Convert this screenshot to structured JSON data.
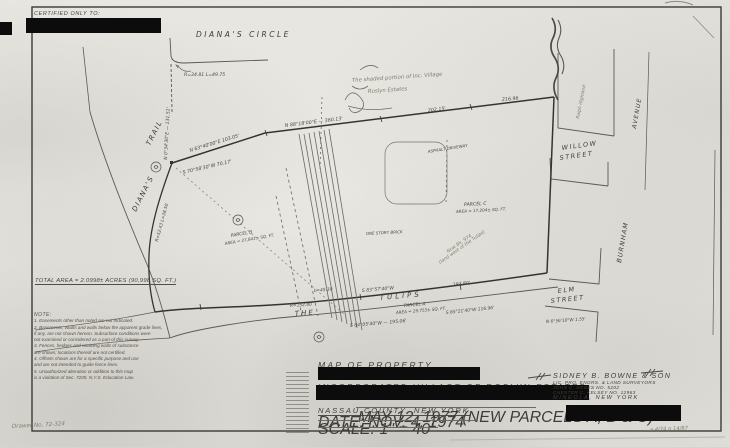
{
  "certified": {
    "label": "CERTIFIED ONLY TO:"
  },
  "streets": {
    "dianas_circle": "DIANA'S   CIRCLE",
    "dianas": "DIANA'S",
    "trail": "TRAIL",
    "the": "THE",
    "tulips": "TULIPS",
    "willow_1": "WILLOW",
    "willow_2": "STREET",
    "elm_1": "ELM",
    "elm_2": "STREET",
    "burnham": "BURNHAM",
    "avenue": "AVENUE"
  },
  "bearings": {
    "circle_curve": "R=34.81  L=49.75",
    "trail_vertical": "N 0°34'30\"E — 131.51'",
    "trail_curve": "R=52.43  L=38.50",
    "north_1": "N 63°40'00\"E  103.05'",
    "junction": "S 70°58'30\"W  70.17'",
    "north_2": "N 88°18'00\"E — 360.13'",
    "north_2b": "202.15'",
    "north_2c": "216.96",
    "tulips_arc": "L=45.30",
    "tulips_1": "S 83°57'40\"W",
    "tulips_1b": "193.80'",
    "tulips_radius": "R=152.80",
    "tulips_2": "S 84°05'40\"W — 195.06'",
    "tulips_3": "S 85°21'40\"W   116.96'",
    "elm_offset": "N 6°56'10\"W  1.55'"
  },
  "parcels": {
    "a_name": "PARCEL A",
    "a_area": "AREA = 29,753± SQ. FT.",
    "b_name": "PARCEL B",
    "b_area": "AREA = 27,841± SQ. FT.",
    "c_name": "PARCEL C",
    "c_area": "AREA = 17,204± SQ. FT.",
    "total": "TOTAL AREA = 2.0998± ACRES  (90,998 SQ. FT.)"
  },
  "building": {
    "label": "ONE STORY BRICK",
    "driveway": "ASPHALT DRIVEWAY"
  },
  "handwritten": {
    "shaded_1": "The shaded portion of Inc. Village",
    "shaded_2": "Roslyn Estates",
    "bldg_note_1": "Now Bk. 974",
    "bldg_note_2": "(land west of the Tulips)",
    "highland": "Ralph Highland",
    "filed": "a 4/74   p 14/87",
    "drawer": "Drawer No. 72-324"
  },
  "notes": {
    "heading": "NOTE:",
    "lines": [
      "1. Easements other than noted are not indicated.",
      "2. Basements, vaults and walls below the apparent grade lines,",
      "    if any, are not shown hereon. Subsurface conditions were",
      "    not examined or considered as a part of this survey.",
      "3. Fences, hedges and retaining walls of substance",
      "    are shown; locations thereof are not certified.",
      "4. Offsets shown are for a specific purpose and use",
      "    and are not intended to guide fence lines.",
      "5. Unauthorized alteration or addition to this map",
      "    is a violation of Sec. 7209, N.Y.S. Education Law."
    ]
  },
  "title_block": {
    "line_1": "MAP OF PROPERTY",
    "line_2": "INCORPORATED VILLAGE OF ROSLYN ESTATES",
    "line_3": "NASSAU COUNTY, NEW YORK",
    "revision": "MAY 12, 1977  (NEW PARCELS A, B & C)",
    "date": "DATE:   NOV. 4, 1974",
    "scale": "SCALE:   1\" = 40'"
  },
  "surveyor_block": {
    "firm": "SIDNEY B. BOWNE & SON",
    "subtitle": "LIC. PRO. ENGRS. & LAND SURVEYORS",
    "surveyor_1": "JOHN C. GEBES   NO. 5202",
    "surveyor_2": "CHESTER C. KELSEY   NO. 12963",
    "city": "MINEOLA,   NEW YORK"
  }
}
